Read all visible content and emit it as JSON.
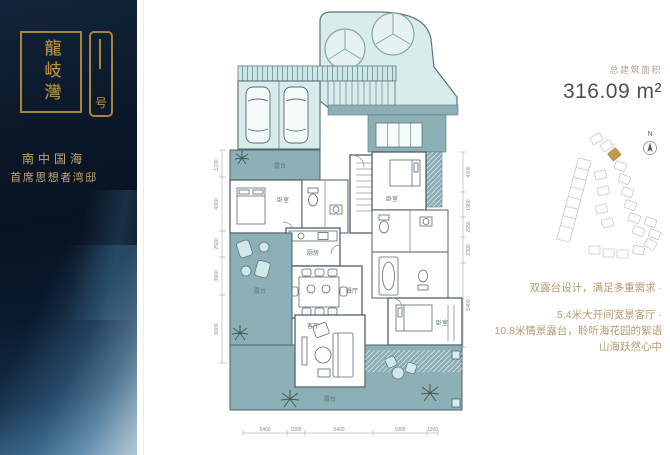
{
  "sidebar": {
    "logo_main": "龍岐灣",
    "logo_sub": "号",
    "tagline_1": "南中国海",
    "tagline_2": "首席思想者湾邸"
  },
  "plan": {
    "rooms": {
      "terrace": "露台",
      "bedroom": "卧室",
      "kitchen": "厨房",
      "dining": "餐厅",
      "living": "客厅"
    },
    "dims": {
      "left": [
        "1700",
        "4300",
        "2500",
        "3900",
        "6000"
      ],
      "right": [
        "4200",
        "1950",
        "2250",
        "2300",
        "5400"
      ],
      "bottom": [
        "5400",
        "1500",
        "5400",
        "1900",
        "1200"
      ]
    }
  },
  "right_panel": {
    "area_label": "总建筑面积",
    "area_value": "316.09 m²",
    "compass_label": "N",
    "features": [
      "双露台设计，满足多重需求 ·",
      "5.4米大开间宽景客厅 ·",
      "10.8米情景露台，聆听海花园的絮语",
      "山海跃然心中"
    ]
  },
  "colors": {
    "sidebar_navy": "#0a1828",
    "gold": "#b8913f",
    "plan_fill": "#d9ecec",
    "deck_fill": "#8cb0b6",
    "wall": "#4e616a",
    "feature_text": "#b49a6d",
    "area_text": "#4f4f4f"
  }
}
